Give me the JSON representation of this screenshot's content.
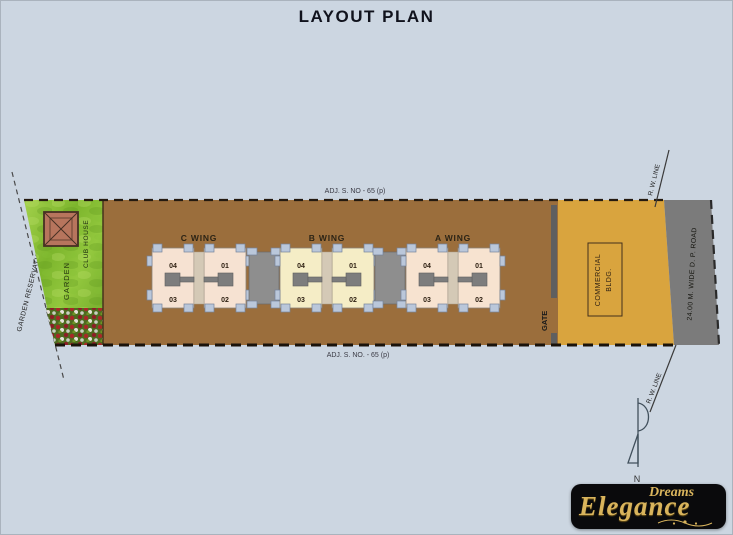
{
  "title": "LAYOUT PLAN",
  "plan": {
    "adj_top": "ADJ. S. NO - 65 (p)",
    "adj_bottom": "ADJ. S. NO. - 65 (p)",
    "garden_reservation": "GARDEN RESERVATION",
    "garden_label": "GARDEN",
    "club_house_label": "CLUB HOUSE",
    "gate_label": "GATE",
    "commercial_line1": "COMMERCIAL",
    "commercial_line2": "BLDG.",
    "road_label": "24.00 M. WIDE D. P. ROAD",
    "rw_line_top": "R. W. LINE",
    "rw_line_bottom": "R. W. LINE",
    "north_label": "N",
    "wings": [
      {
        "label": "C WING",
        "color": "#f6e2d2",
        "units": [
          "04",
          "01",
          "03",
          "02"
        ]
      },
      {
        "label": "B WING",
        "color": "#f5edc6",
        "units": [
          "04",
          "01",
          "03",
          "02"
        ]
      },
      {
        "label": "A WING",
        "color": "#f7e3d0",
        "units": [
          "04",
          "01",
          "03",
          "02"
        ]
      }
    ],
    "colors": {
      "background": "#ccd6e1",
      "plot_brown": "#9b6e3c",
      "commercial_yellow": "#d9a43e",
      "road_gray": "#7b7b7b",
      "gate_gray": "#5f5f5f",
      "balcony_tab_blue": "#bac7da",
      "core_gray": "#7d7d7d",
      "garden_green": "#7ab32e",
      "club_house_terracotta": "#b7755d"
    }
  },
  "logo": {
    "line1": "Dreams",
    "line2": "Elegance",
    "gold": "#d9b45c",
    "background": "#0a0a0c"
  }
}
